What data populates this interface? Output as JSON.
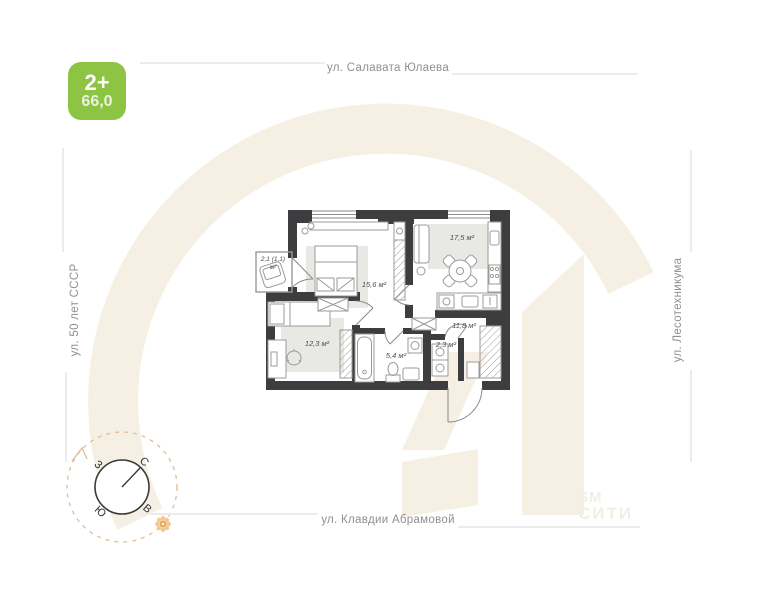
{
  "badge": {
    "rooms_label": "2+",
    "area_value": "66,0",
    "color": "#8dc444"
  },
  "streets": {
    "top": "ул. Салавата Юлаева",
    "left": "ул. 50 лет СССР",
    "right": "ул. Лесотехникума",
    "bottom": "ул. Клавдии Абрамовой"
  },
  "plan": {
    "rooms": {
      "bedroom": "15,6 м²",
      "kitchen_living": "17,5 м²",
      "bedroom2": "12,3 м²",
      "bathroom": "5,4 м²",
      "wc": "2,3 м²",
      "hallway": "11,8 м²",
      "balcony_line1": "2,1 (1,1)",
      "balcony_line2": "м²"
    },
    "wall_color": "#3d3d40",
    "rug_color": "#e8e8e4"
  },
  "compass": {
    "north": "С",
    "east": "В",
    "south": "Ю",
    "west": "З"
  },
  "watermark": {
    "corner_line1": "SM",
    "corner_line2": "СИТИ",
    "shape_color": "#f6f0e4"
  }
}
